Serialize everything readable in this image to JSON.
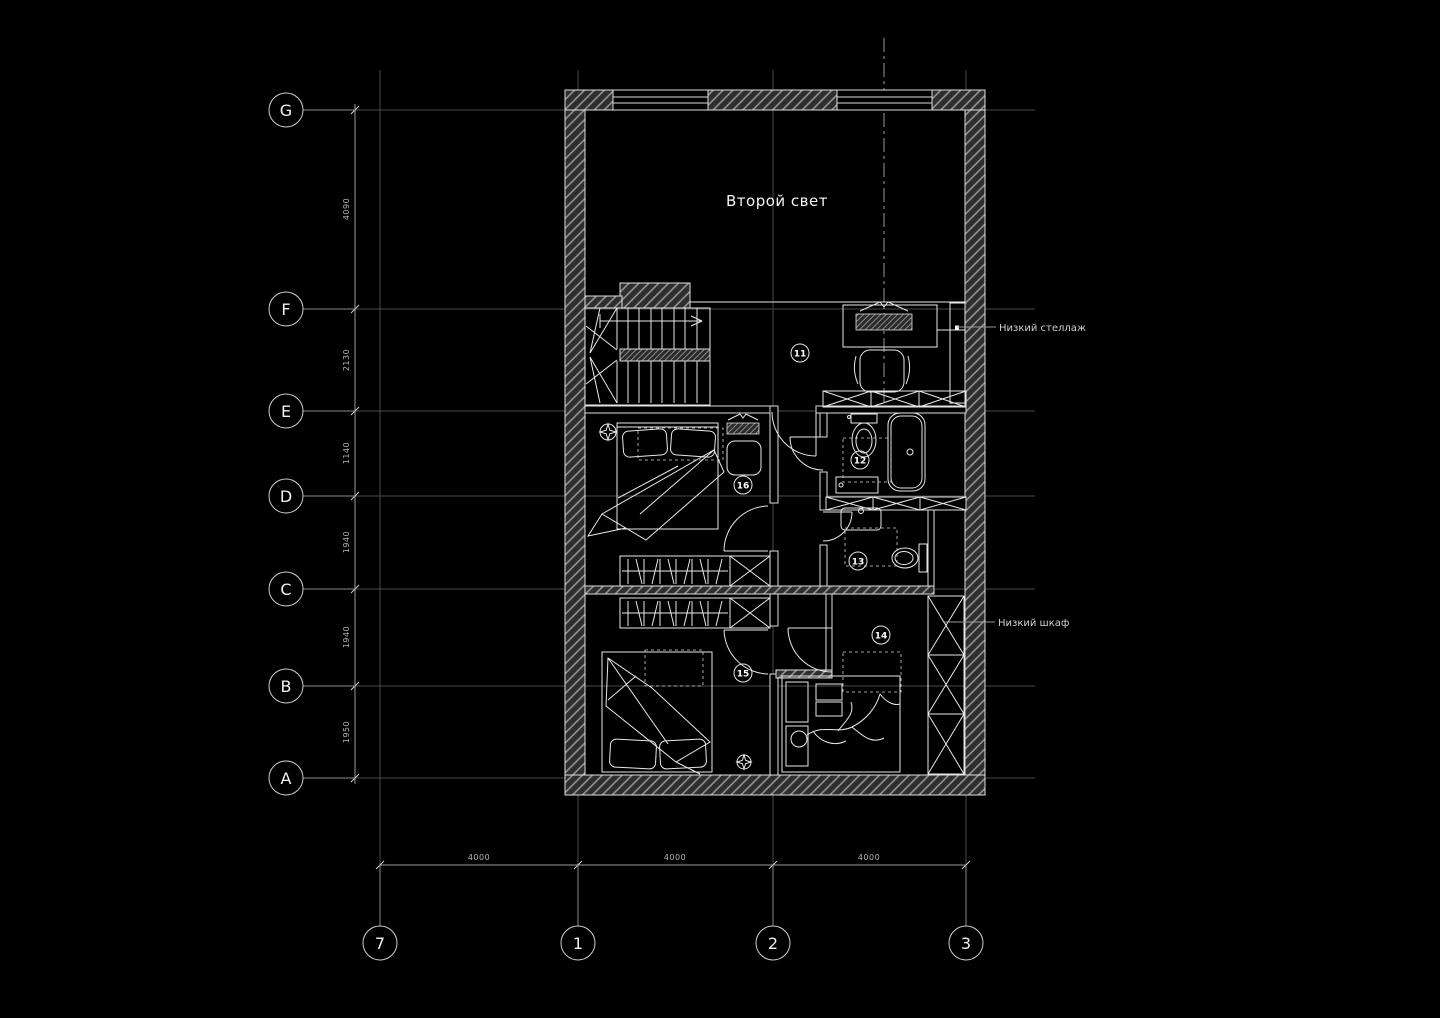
{
  "colors": {
    "background": "#000000",
    "linework": "#e8e8e8",
    "grid_line": "#4a4a4a",
    "dimension": "#9a9a9a",
    "wall_hatch": "#9a9a9a"
  },
  "plan": {
    "title": "Второй свет",
    "annotations": {
      "low_shelf": "Низкий стеллаж",
      "low_cabinet": "Низкий шкаф"
    }
  },
  "grid": {
    "rows": [
      {
        "label": "G"
      },
      {
        "label": "F"
      },
      {
        "label": "E"
      },
      {
        "label": "D"
      },
      {
        "label": "C"
      },
      {
        "label": "B"
      },
      {
        "label": "A"
      }
    ],
    "row_dims": [
      "4090",
      "2130",
      "1140",
      "1940",
      "1940",
      "1950"
    ],
    "cols": [
      {
        "label": "7"
      },
      {
        "label": "1"
      },
      {
        "label": "2"
      },
      {
        "label": "3"
      }
    ],
    "col_dims": [
      "4000",
      "4000",
      "4000"
    ]
  },
  "rooms": [
    {
      "number": "11"
    },
    {
      "number": "12"
    },
    {
      "number": "13"
    },
    {
      "number": "14"
    },
    {
      "number": "15"
    },
    {
      "number": "16"
    }
  ]
}
